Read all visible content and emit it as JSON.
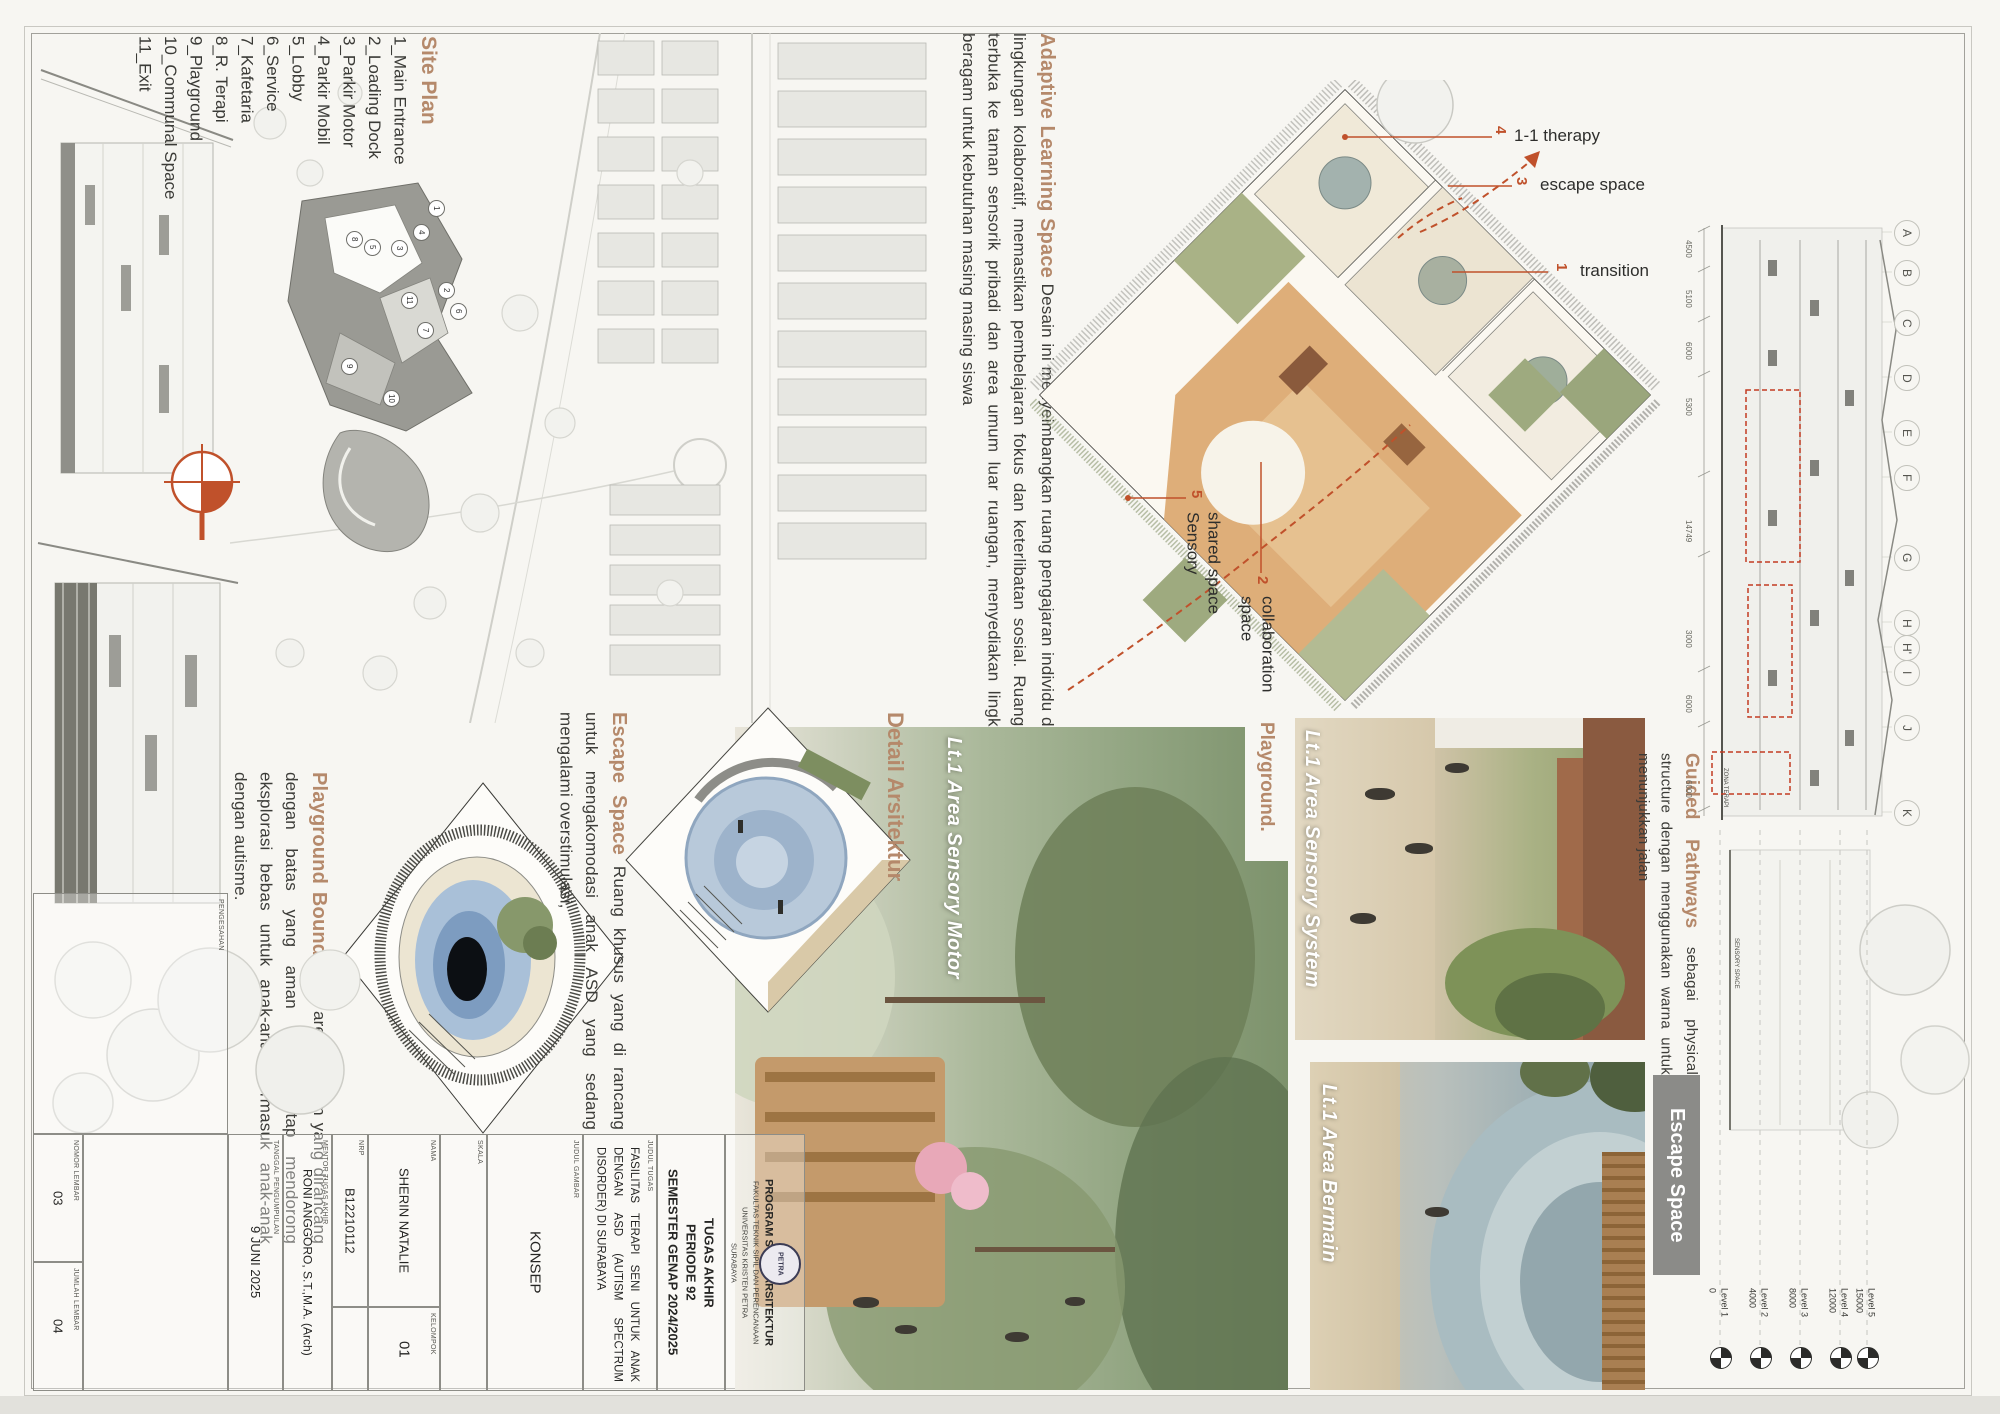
{
  "site_plan": {
    "title": "Site Plan",
    "items": [
      "1_Main Entrance",
      "2_Loading Dock",
      "3_Parkir Motor",
      "4_Parkir Mobil",
      "5_Lobby",
      "6_Service",
      "7_Kafetaria",
      "8_R. Terapi",
      "9_Playground",
      "10_Communal Space",
      "11_Exit"
    ],
    "badges": [
      "1",
      "2",
      "3",
      "4",
      "5",
      "6",
      "7",
      "8",
      "9",
      "10",
      "11"
    ]
  },
  "adaptive": {
    "title": "Adaptive Learning Space",
    "body": "Desain ini menyeimbangkan ruang pengajaran individu dengan lingkungan kolaboratif, memastikan pembelajaran fokus dan keterlibatan sosial. Ruang kelas terbuka ke taman sensorik pribadi dan area umum luar ruangan, menyediakan lingkungan beragam untuk kebutuhan masing masing siswa"
  },
  "plan_labels": {
    "therapy": {
      "num": "4",
      "label": "1-1 therapy"
    },
    "escape": {
      "num": "3",
      "label": "escape space"
    },
    "transition": {
      "num": "1",
      "label": "transition"
    },
    "sensory": {
      "num": "5",
      "line1": "Sensory",
      "line2": "shared space"
    },
    "collab": {
      "num": "2",
      "line1": "collaboration",
      "line2": "space"
    }
  },
  "playground_boundaries": {
    "title": "Playground Boundaries",
    "body": "area bermain yang dirancang dengan batas yang aman namun tetap mendorong eksplorasi bebas untuk anak-anak, termasuk anak-anak dengan autisme."
  },
  "escape_space": {
    "title": "Escape Space",
    "body": "Ruang khusus yang di rancang untuk mengakomodasi anak ASD yang sedang mengalami overstimulasi,"
  },
  "detail_arsitektur": {
    "title": "Detail Arsitektur"
  },
  "guided_pathways": {
    "title": "Guided Pathways",
    "body": "sebagai physical structure dengan menggunakan warna untuk menunjukkan jalan"
  },
  "renders": {
    "sensory_motor": "Lt.1 Area Sensory Motor",
    "sensory_system": "Lt.1 Area Sensory System",
    "bermain": "Lt.1 Area Bermain",
    "playground_heading": "Playground.",
    "escape_bar": "Escape Space"
  },
  "elevation": {
    "grid": [
      "A",
      "B",
      "C",
      "D",
      "E",
      "F",
      "G",
      "H",
      "H'",
      "I",
      "J",
      "K"
    ],
    "dims": [
      "4500",
      "5100",
      "6000",
      "5300",
      "14749",
      "3000",
      "6000",
      "6000"
    ],
    "tags": {
      "zona": "ZONA TERAPI",
      "sensory": "SENSORY SPACE"
    },
    "levels": [
      {
        "name": "Level 1",
        "value": "0"
      },
      {
        "name": "Level 2",
        "value": "4000"
      },
      {
        "name": "Level 3",
        "value": "8000"
      },
      {
        "name": "Level 4",
        "value": "12000"
      },
      {
        "name": "Level 5",
        "value": "15000"
      }
    ]
  },
  "title_block": {
    "nomor": {
      "label": "NOMOR LEMBAR",
      "value": "03"
    },
    "jumlah": {
      "label": "JUMLAH LEMBAR",
      "value": "04"
    },
    "pengesahan": {
      "label": "PENGESAHAN"
    },
    "tanggal": {
      "label": "TANGGAL PENGUMPULAN",
      "value": "9 JUNI 2025"
    },
    "mentor": {
      "label": "MENTOR TUGAS AKHIR",
      "value": "RONI ANGGORO, S.T.,M.A. (Arch)"
    },
    "nrp": {
      "label": "NRP",
      "value": "B12210112"
    },
    "kelompok": {
      "label": "KELOMPOK",
      "value": "01"
    },
    "nama": {
      "label": "NAMA",
      "value": "SHERIN NATALIE"
    },
    "skala": {
      "label": "SKALA"
    },
    "judul_gambar": {
      "label": "JUDUL GAMBAR",
      "value": "KONSEP"
    },
    "judul_tugas": {
      "label": "JUDUL TUGAS",
      "value": "FASILITAS TERAPI SENI UNTUK ANAK DENGAN ASD (AUTISM SPECTRUM DISORDER) DI SURABAYA"
    },
    "tugas": {
      "line1": "TUGAS AKHIR",
      "line2": "PERIODE 92",
      "line3": "SEMESTER GENAP 2024/2025"
    },
    "prodi": {
      "line1": "PROGRAM STUDI ARSITEKTUR",
      "line2": "FAKULTAS TEKNIK SIPIL DAN PERENCANAAN",
      "line3": "UNIVERSITAS KRISTEN PETRA",
      "line4": "SURABAYA",
      "logo": "PETRA"
    }
  }
}
